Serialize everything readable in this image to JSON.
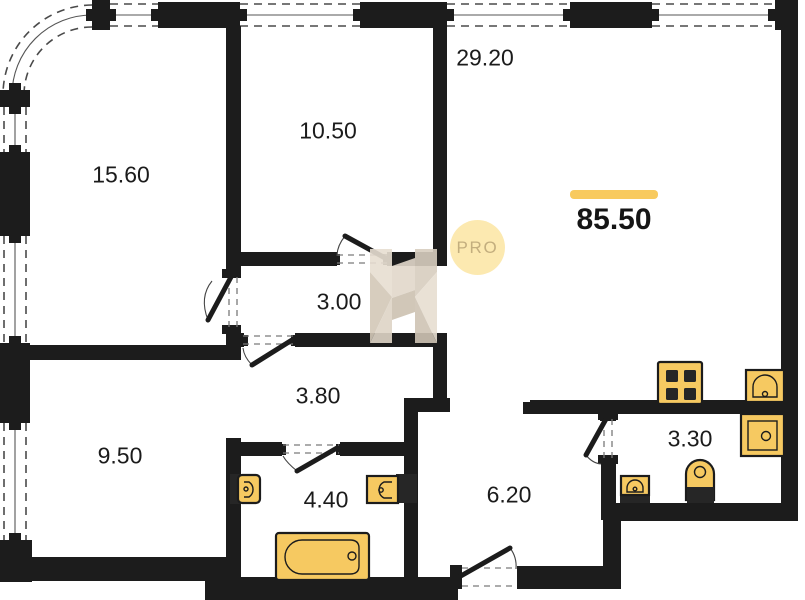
{
  "plan": {
    "total_area": "85.50",
    "watermark": {
      "badge_text": "PRO"
    },
    "rooms": [
      {
        "id": "room-top-left",
        "area": "15.60"
      },
      {
        "id": "room-top-middle",
        "area": "10.50"
      },
      {
        "id": "living-kitchen",
        "area": "29.20"
      },
      {
        "id": "corridor-upper",
        "area": "3.00"
      },
      {
        "id": "corridor-lower",
        "area": "3.80"
      },
      {
        "id": "room-bottom-left",
        "area": "9.50"
      },
      {
        "id": "bathroom",
        "area": "4.40"
      },
      {
        "id": "entry-hall",
        "area": "6.20"
      },
      {
        "id": "wc",
        "area": "3.30"
      }
    ],
    "colors": {
      "wall": "#1c1c1c",
      "fixture": "#f6c961",
      "fixture-dark": "#262626",
      "accent": "#f8ca5e",
      "pro-bg": "#fce9b0",
      "pro-text": "#c3ae7e"
    }
  }
}
